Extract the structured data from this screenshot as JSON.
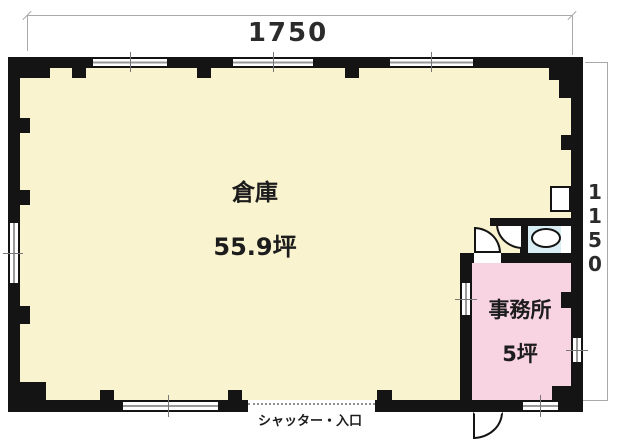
{
  "plan": {
    "dimensions": {
      "width_label": "1750",
      "height_label": "1150"
    },
    "rooms": {
      "warehouse": {
        "name": "倉庫",
        "area": "55.9坪",
        "floor_color": "#faf3cf"
      },
      "office": {
        "name": "事務所",
        "area": "5坪",
        "floor_color": "#f8d3e2"
      },
      "toilet": {
        "floor_color": "#d8edf4",
        "fixtures": [
          "toilet-bowl",
          "hand-basin"
        ]
      }
    },
    "labels": {
      "entrance": "シャッター・入口"
    },
    "colors": {
      "wall": "#141414",
      "dimension_line": "#a9a9a9",
      "background": "#ffffff"
    }
  }
}
